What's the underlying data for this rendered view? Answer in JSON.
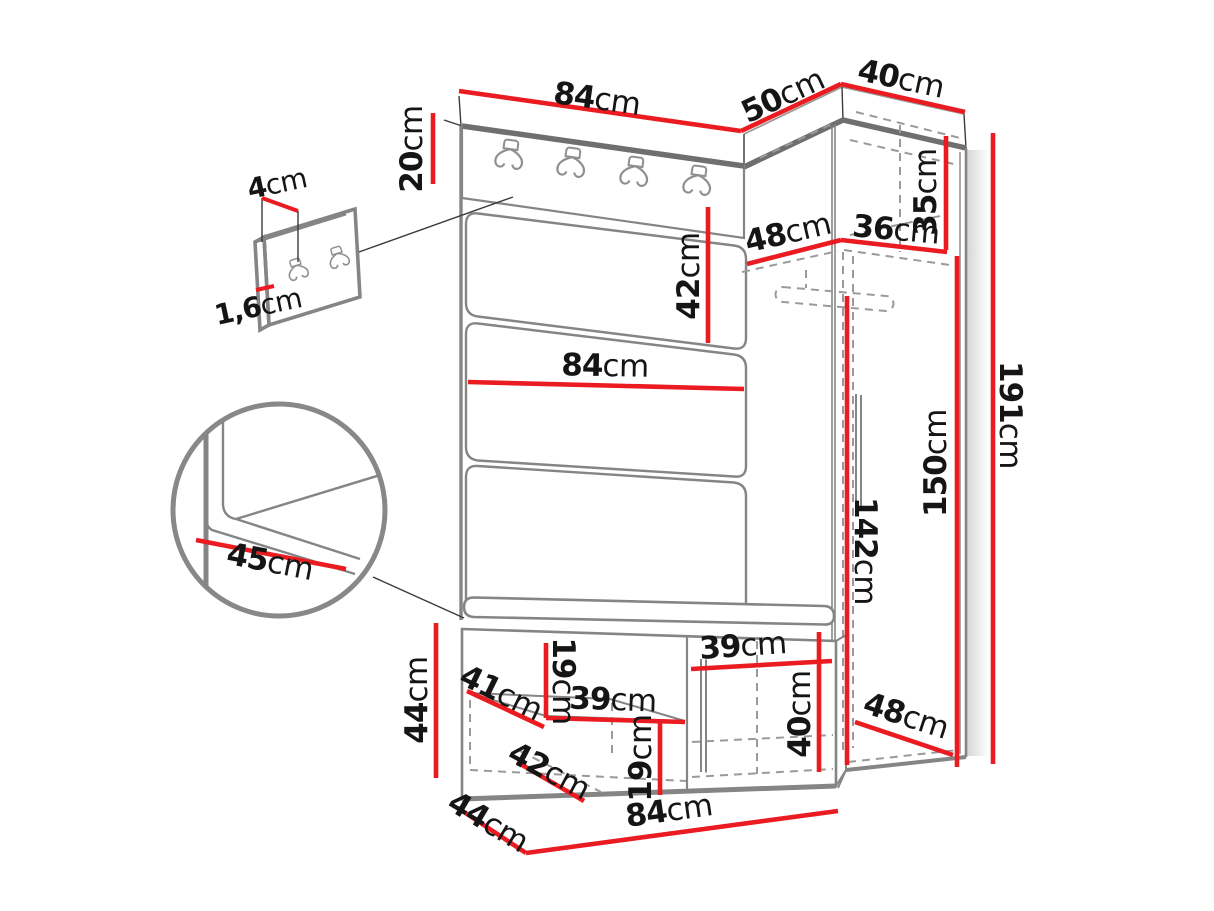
{
  "diagram": {
    "title": "hallway-set-dimension-diagram",
    "unit": "cm",
    "colors": {
      "dimension_line": "#ea1c21",
      "outline": "#858585",
      "label_text": "#151515",
      "background": "#ffffff"
    },
    "labels": {
      "top_width": {
        "num": "84",
        "unit": "cm"
      },
      "top_depth": {
        "num": "50",
        "unit": "cm"
      },
      "corner_top_width": {
        "num": "40",
        "unit": "cm"
      },
      "hook_board_height": {
        "num": "20",
        "unit": "cm"
      },
      "hook_plate_width": {
        "num": "4",
        "unit": "cm"
      },
      "hook_plate_thickness": {
        "num": "1,6",
        "unit": "cm"
      },
      "panel_height": {
        "num": "42",
        "unit": "cm"
      },
      "panel_width": {
        "num": "84",
        "unit": "cm"
      },
      "niche_depth": {
        "num": "48",
        "unit": "cm"
      },
      "niche_width": {
        "num": "36",
        "unit": "cm"
      },
      "top_shelf_height": {
        "num": "35",
        "unit": "cm"
      },
      "total_height": {
        "num": "191",
        "unit": "cm"
      },
      "interior_height": {
        "num": "150",
        "unit": "cm"
      },
      "rail_height": {
        "num": "142",
        "unit": "cm"
      },
      "seat_depth": {
        "num": "45",
        "unit": "cm"
      },
      "bench_height": {
        "num": "44",
        "unit": "cm"
      },
      "bench_shelf_depth": {
        "num": "41",
        "unit": "cm"
      },
      "upper_gap_height": {
        "num": "19",
        "unit": "cm"
      },
      "upper_shelf_width": {
        "num": "39",
        "unit": "cm"
      },
      "lower_shelf_depth": {
        "num": "42",
        "unit": "cm"
      },
      "lower_gap_height": {
        "num": "19",
        "unit": "cm"
      },
      "door_width": {
        "num": "39",
        "unit": "cm"
      },
      "door_height": {
        "num": "40",
        "unit": "cm"
      },
      "bench_depth": {
        "num": "44",
        "unit": "cm"
      },
      "bench_width": {
        "num": "84",
        "unit": "cm"
      },
      "wardrobe_floor_depth": {
        "num": "48",
        "unit": "cm"
      }
    }
  }
}
